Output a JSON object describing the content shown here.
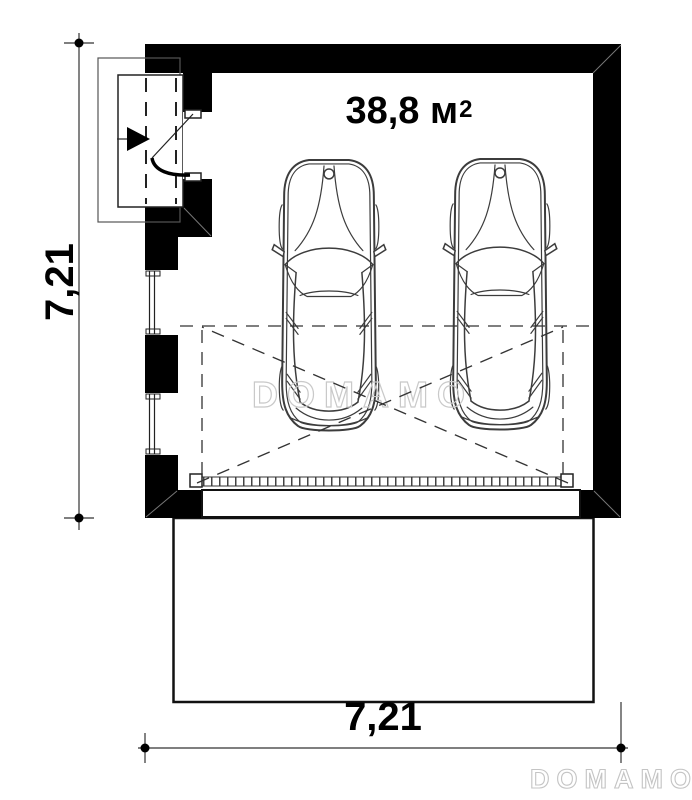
{
  "plan": {
    "area": {
      "value": "38,8",
      "unit": "м",
      "superscript": "2"
    },
    "dimensions": {
      "height_left": "7,21",
      "width_bottom": "7,21"
    },
    "watermarks": {
      "center": "DOMAMO",
      "corner": "DOMAMO"
    },
    "colors": {
      "wall": "#000000",
      "line": "#222222",
      "dashed_line": "#333333",
      "watermark": "#c9c9c9",
      "background": "#ffffff"
    }
  }
}
